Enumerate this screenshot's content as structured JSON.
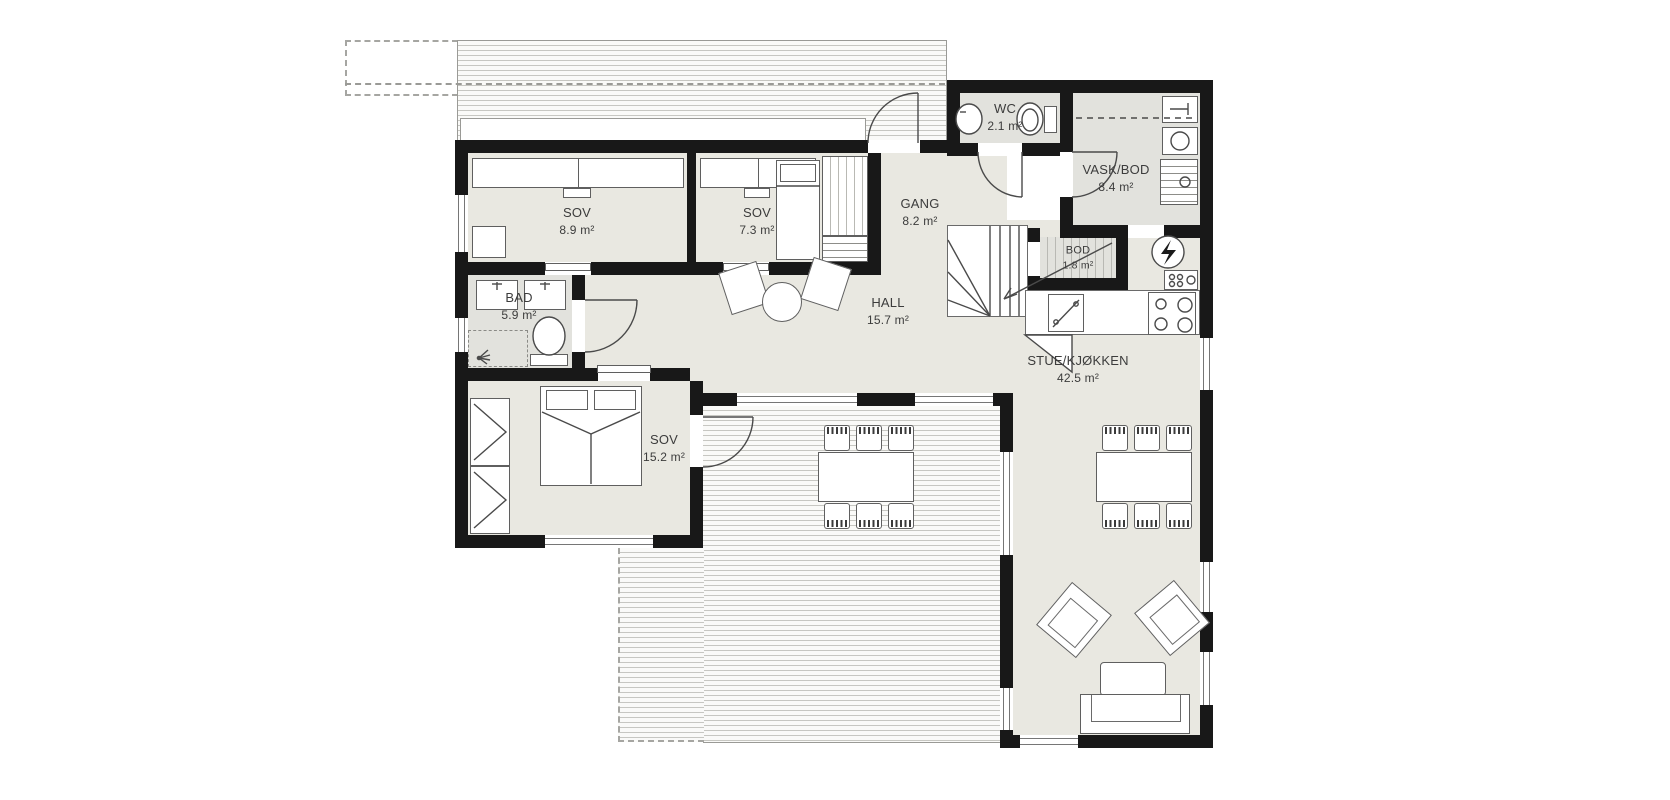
{
  "rooms": {
    "sov1": {
      "name": "SOV",
      "area": "8.9 m²"
    },
    "sov2": {
      "name": "SOV",
      "area": "7.3 m²"
    },
    "gang": {
      "name": "GANG",
      "area": "8.2 m²"
    },
    "wc": {
      "name": "WC",
      "area": "2.1 m²"
    },
    "vaskbod": {
      "name": "VASK/BOD",
      "area": "8.4 m²"
    },
    "bod": {
      "name": "BOD",
      "area": "1.8 m²"
    },
    "hall": {
      "name": "HALL",
      "area": "15.7 m²"
    },
    "bad": {
      "name": "BAD",
      "area": "5.9 m²"
    },
    "sov3": {
      "name": "SOV",
      "area": "15.2 m²"
    },
    "stue": {
      "name": "STUE/KJØKKEN",
      "area": "42.5 m²"
    }
  },
  "colors": {
    "wall": "#181818",
    "room_fill": "#e9e8e1",
    "wet_room_fill": "#e2e2dd",
    "deck_stripe": "#c7c7c2",
    "furniture_outline": "#5f5f5f",
    "background": "#ffffff"
  },
  "icons": {
    "power": "lightning-bolt-in-circle",
    "stove": "four-burner-circles",
    "dishwasher": "diagonal-with-dots",
    "shower": "spray-fan",
    "toilet": "oval-bowl-with-tank",
    "washer": "striped-box-with-dot"
  }
}
